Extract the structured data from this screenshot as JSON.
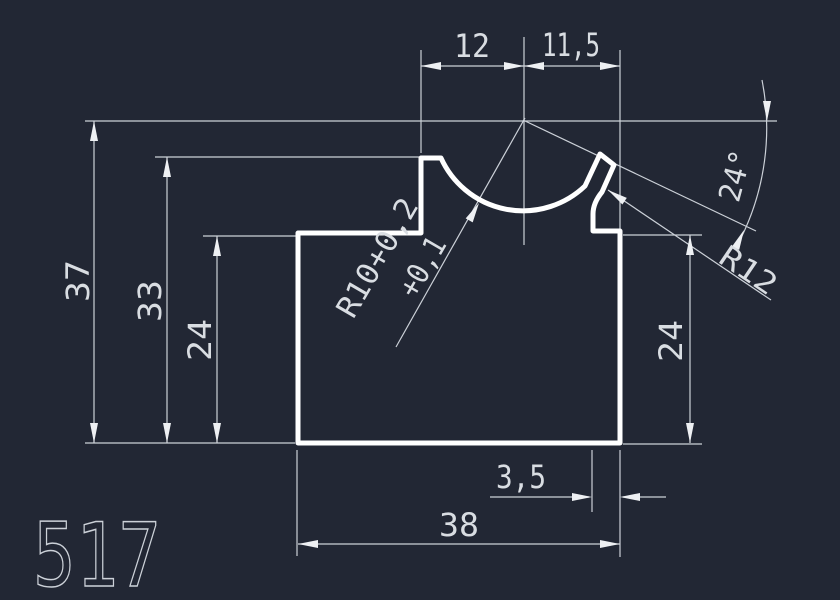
{
  "drawing": {
    "part_number": "517",
    "dimensions": {
      "top_width_left": "12",
      "top_width_right": "11,5",
      "height_total": "37",
      "height_step": "33",
      "height_left_shoulder": "24",
      "height_right_shoulder": "24",
      "bottom_offset": "3,5",
      "bottom_width": "38",
      "groove_radius_line1": "R10+0,2",
      "groove_radius_line2": "+0,1",
      "tip_angle": "24°",
      "tip_radius": "R12"
    },
    "colors": {
      "background": "#222734",
      "profile_line": "#ffffff",
      "dimension_line": "#ccd1d8",
      "text": "#d9dde2"
    }
  }
}
